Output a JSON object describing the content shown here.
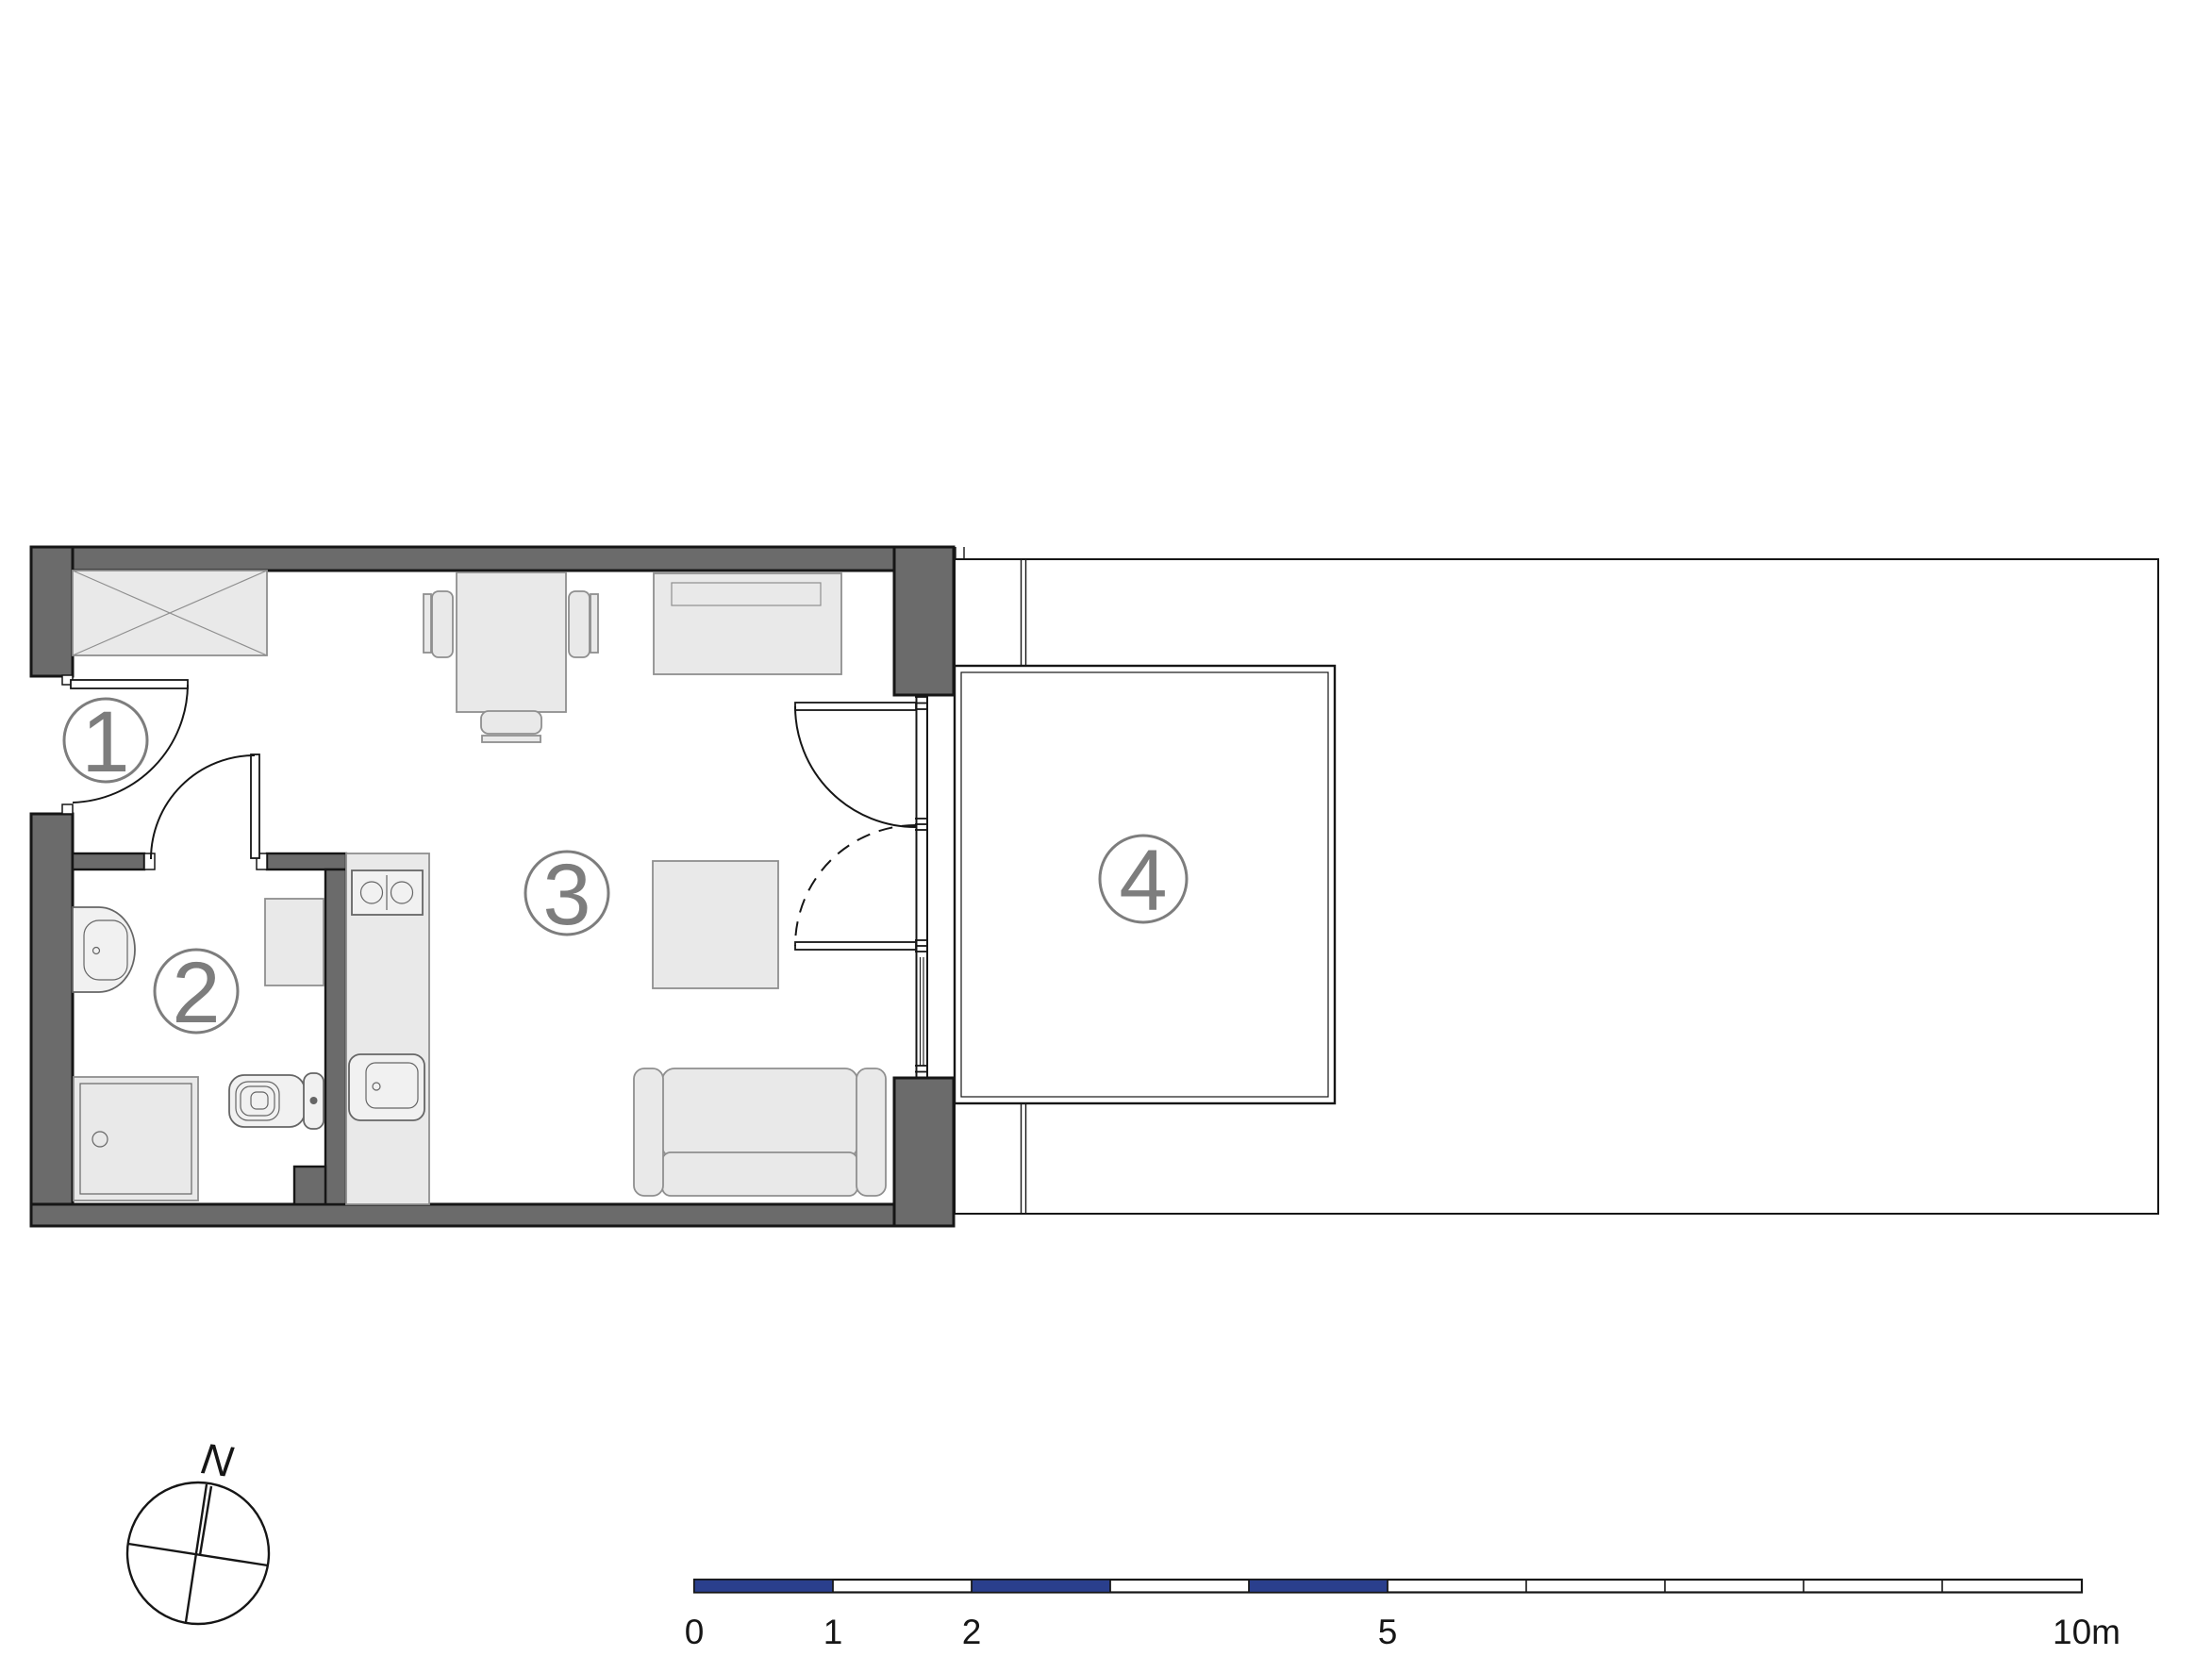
{
  "rooms": [
    {
      "label": "1"
    },
    {
      "label": "2"
    },
    {
      "label": "3"
    },
    {
      "label": "4"
    }
  ],
  "compass": {
    "label": "N"
  },
  "scale_bar": {
    "labels": [
      "0",
      "1",
      "2",
      "5",
      "10m"
    ]
  },
  "colors": {
    "paper": "#ffffff",
    "ink": "#161616",
    "wall": "#6b6b6b",
    "furn_fill": "#e9e9e9",
    "furn_line": "#8f8f8f",
    "fixture_fill": "#f1f1f1",
    "fixture_line": "#666666",
    "label_gray": "#7d7d7d",
    "scale_blue": "#2a3f8d"
  }
}
